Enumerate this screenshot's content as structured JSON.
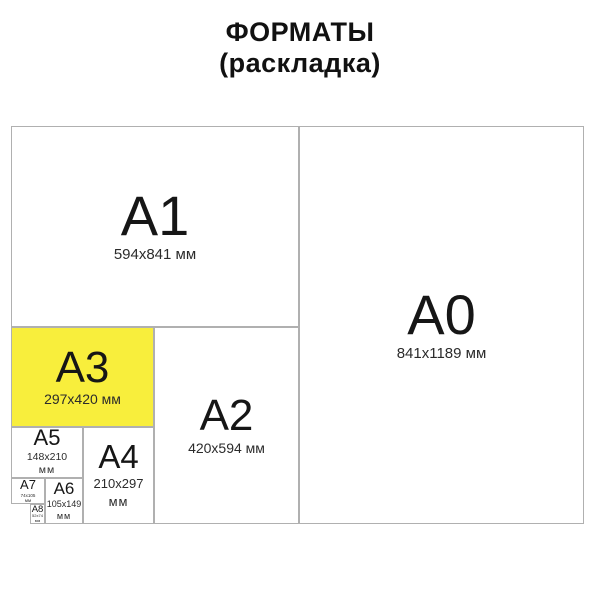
{
  "title": {
    "line1": "ФОРМАТЫ",
    "line2": "(раскладка)"
  },
  "colors": {
    "highlight_yellow": "#f8ee3c",
    "border_gray": "#b0b0b0",
    "text_black": "#161616"
  },
  "boxes": {
    "a1": {
      "label": "A1",
      "dims": "594x841 мм"
    },
    "a0": {
      "label": "A0",
      "dims": "841x1189 мм"
    },
    "a3": {
      "label": "A3",
      "dims": "297x420 мм",
      "highlighted": true
    },
    "a2": {
      "label": "A2",
      "dims": "420x594 мм"
    },
    "a5": {
      "label": "A5",
      "dims": "148x210",
      "unit": "мм"
    },
    "a4": {
      "label": "A4",
      "dims": "210x297",
      "unit": "мм"
    },
    "a7": {
      "label": "A7",
      "dims": "74x105",
      "unit": "мм"
    },
    "a6": {
      "label": "A6",
      "dims": "105x149",
      "unit": "мм"
    },
    "a8": {
      "label": "A8",
      "dims": "52x74",
      "unit": "мм"
    }
  }
}
